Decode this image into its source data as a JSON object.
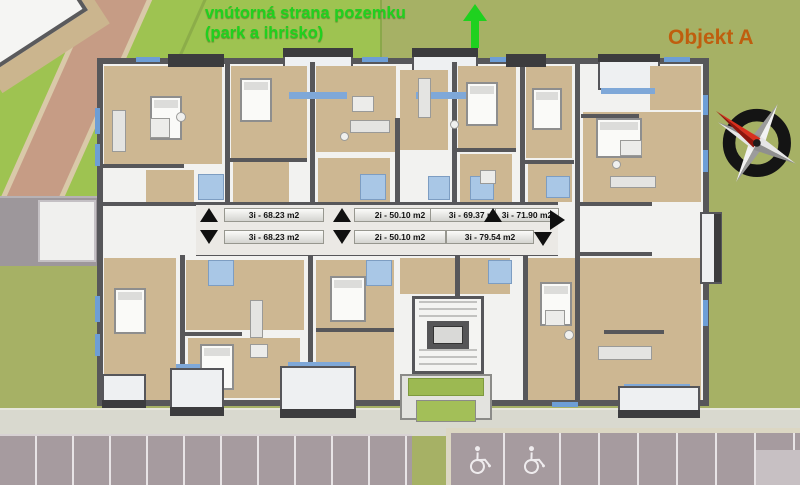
{
  "site_note": {
    "line1": "vnútorná strana pozemku",
    "line2": "(park a ihrisko)"
  },
  "building": {
    "name": "Objekt A"
  },
  "units": {
    "top_row": [
      {
        "label": "3i - 68.23 m2"
      },
      {
        "label": "2i - 50.10 m2"
      },
      {
        "label": "3i - 69.37 m2"
      },
      {
        "label": "3i - 71.90 m2"
      }
    ],
    "bottom_row": [
      {
        "label": "3i - 68.23 m2"
      },
      {
        "label": "2i - 50.10 m2"
      },
      {
        "label": "3i - 79.54 m2"
      }
    ]
  },
  "icons": {
    "site_direction": "up-arrow",
    "unit_arrows": [
      "up-triangle",
      "down-triangle",
      "right-triangle"
    ],
    "compass": "compass-rose",
    "accessible_parking": "wheelchair"
  },
  "colors": {
    "note_green": "#1fd11f",
    "object_label_orange": "#bf5e0e",
    "lawn": "#a6b165",
    "lawn_bright": "#9ec351",
    "path_salmon": "#c69c85",
    "wall_gray": "#57575a",
    "floor_tan": "#cdb792",
    "accent_blue": "#6d9ed6",
    "bath_blue": "#a9c7e6",
    "parking_mauve": "#a69b9f",
    "sidewalk": "#d9d9cf"
  }
}
